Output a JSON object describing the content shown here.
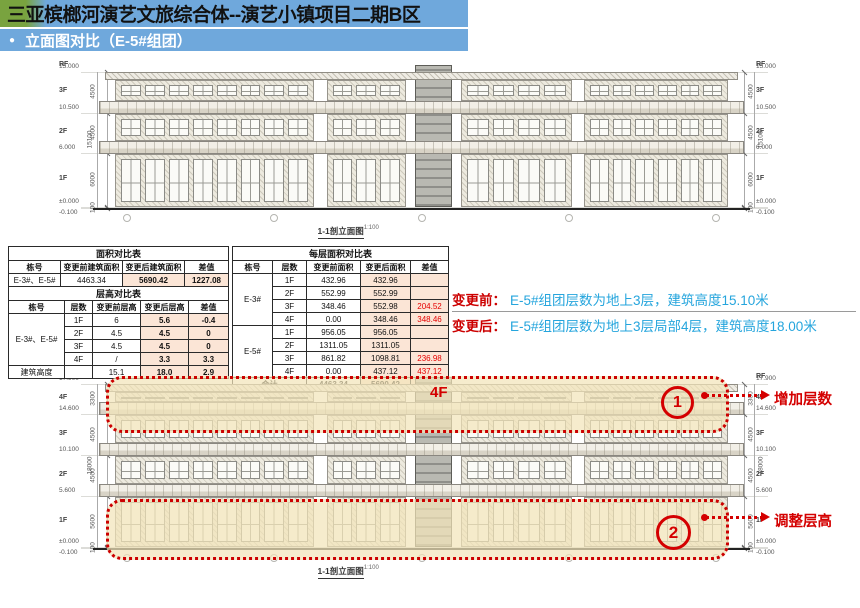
{
  "slide": {
    "title": "三亚槟榔河演艺文旅综合体--演艺小镇项目二期B区",
    "subtitle": "立面图对比（E-5#组团）",
    "bullet": "●"
  },
  "colors": {
    "header_green": "#79a33f",
    "header_blue": "#6fa8dc",
    "table_highlight": "#fbe5d6",
    "annotation_red": "#d40000",
    "note_blue": "#25a5dd",
    "highlight_yellow": "#f2e5ba"
  },
  "tables": {
    "area": {
      "title": "面积对比表",
      "headers": [
        "栋号",
        "变更前建筑面积",
        "变更后建筑面积",
        "差值"
      ],
      "rows": [
        [
          "E-3#、E-5#",
          "4463.34",
          "5690.42",
          "1227.08"
        ]
      ]
    },
    "height": {
      "title": "层高对比表",
      "headers": [
        "栋号",
        "层数",
        "变更前层高",
        "变更后层高",
        "差值"
      ],
      "group_label": "E-3#、E-5#",
      "rows": [
        [
          "1F",
          "6",
          "5.6",
          "-0.4"
        ],
        [
          "2F",
          "4.5",
          "4.5",
          "0"
        ],
        [
          "3F",
          "4.5",
          "4.5",
          "0"
        ],
        [
          "4F",
          "/",
          "3.3",
          "3.3"
        ]
      ],
      "footer": [
        "建筑高度",
        "",
        "15.1",
        "18.0",
        "2.9"
      ]
    },
    "floor_area": {
      "title": "每层面积对比表",
      "headers": [
        "栋号",
        "层数",
        "变更前面积",
        "变更后面积",
        "差值"
      ],
      "groups": [
        {
          "label": "E-3#",
          "rows": [
            [
              "1F",
              "432.96",
              "432.96",
              ""
            ],
            [
              "2F",
              "552.99",
              "552.99",
              ""
            ],
            [
              "3F",
              "348.46",
              "552.98",
              "204.52"
            ],
            [
              "4F",
              "0.00",
              "348.46",
              "348.46"
            ]
          ]
        },
        {
          "label": "E-5#",
          "rows": [
            [
              "1F",
              "956.05",
              "956.05",
              ""
            ],
            [
              "2F",
              "1311.05",
              "1311.05",
              ""
            ],
            [
              "3F",
              "861.82",
              "1098.81",
              "236.98"
            ],
            [
              "4F",
              "0.00",
              "437.12",
              "437.12"
            ]
          ]
        }
      ],
      "total": [
        "合计",
        "4463.34",
        "5690.42",
        "1227.08"
      ]
    }
  },
  "notes": {
    "before_label": "变更前：",
    "before_text": "E-5#组团层数为地上3层，建筑高度15.10米",
    "after_label": "变更后：",
    "after_text": "E-5#组团层数为地上3层局部4层，建筑高度18.00米"
  },
  "drawings": {
    "top": {
      "caption": "1-1剖立面图",
      "scale": "1:100",
      "levels": [
        {
          "name": "RF",
          "elev": "15.000"
        },
        {
          "name": "3F",
          "elev": "10.500"
        },
        {
          "name": "2F",
          "elev": "6.000"
        },
        {
          "name": "1F",
          "elev": "±0.000"
        },
        {
          "name": "",
          "elev": "-0.100"
        }
      ],
      "floor_dims": [
        "4500",
        "4500",
        "6000"
      ],
      "total_dim": "15100",
      "base_dim": "100"
    },
    "bottom": {
      "caption": "1-1剖立面图",
      "scale": "1:100",
      "levels": [
        {
          "name": "RF",
          "elev": "17.900"
        },
        {
          "name": "4F",
          "elev": "14.600"
        },
        {
          "name": "3F",
          "elev": "10.100"
        },
        {
          "name": "2F",
          "elev": "5.600"
        },
        {
          "name": "1F",
          "elev": "±0.000"
        },
        {
          "name": "",
          "elev": "-0.100"
        }
      ],
      "floor_dims": [
        "3300",
        "4500",
        "4500",
        "5600"
      ],
      "total_dim": "18000",
      "base_dim": "100",
      "floor_label": "4F",
      "callouts": [
        {
          "num": "1",
          "label": "增加层数"
        },
        {
          "num": "2",
          "label": "调整层高"
        }
      ]
    }
  }
}
